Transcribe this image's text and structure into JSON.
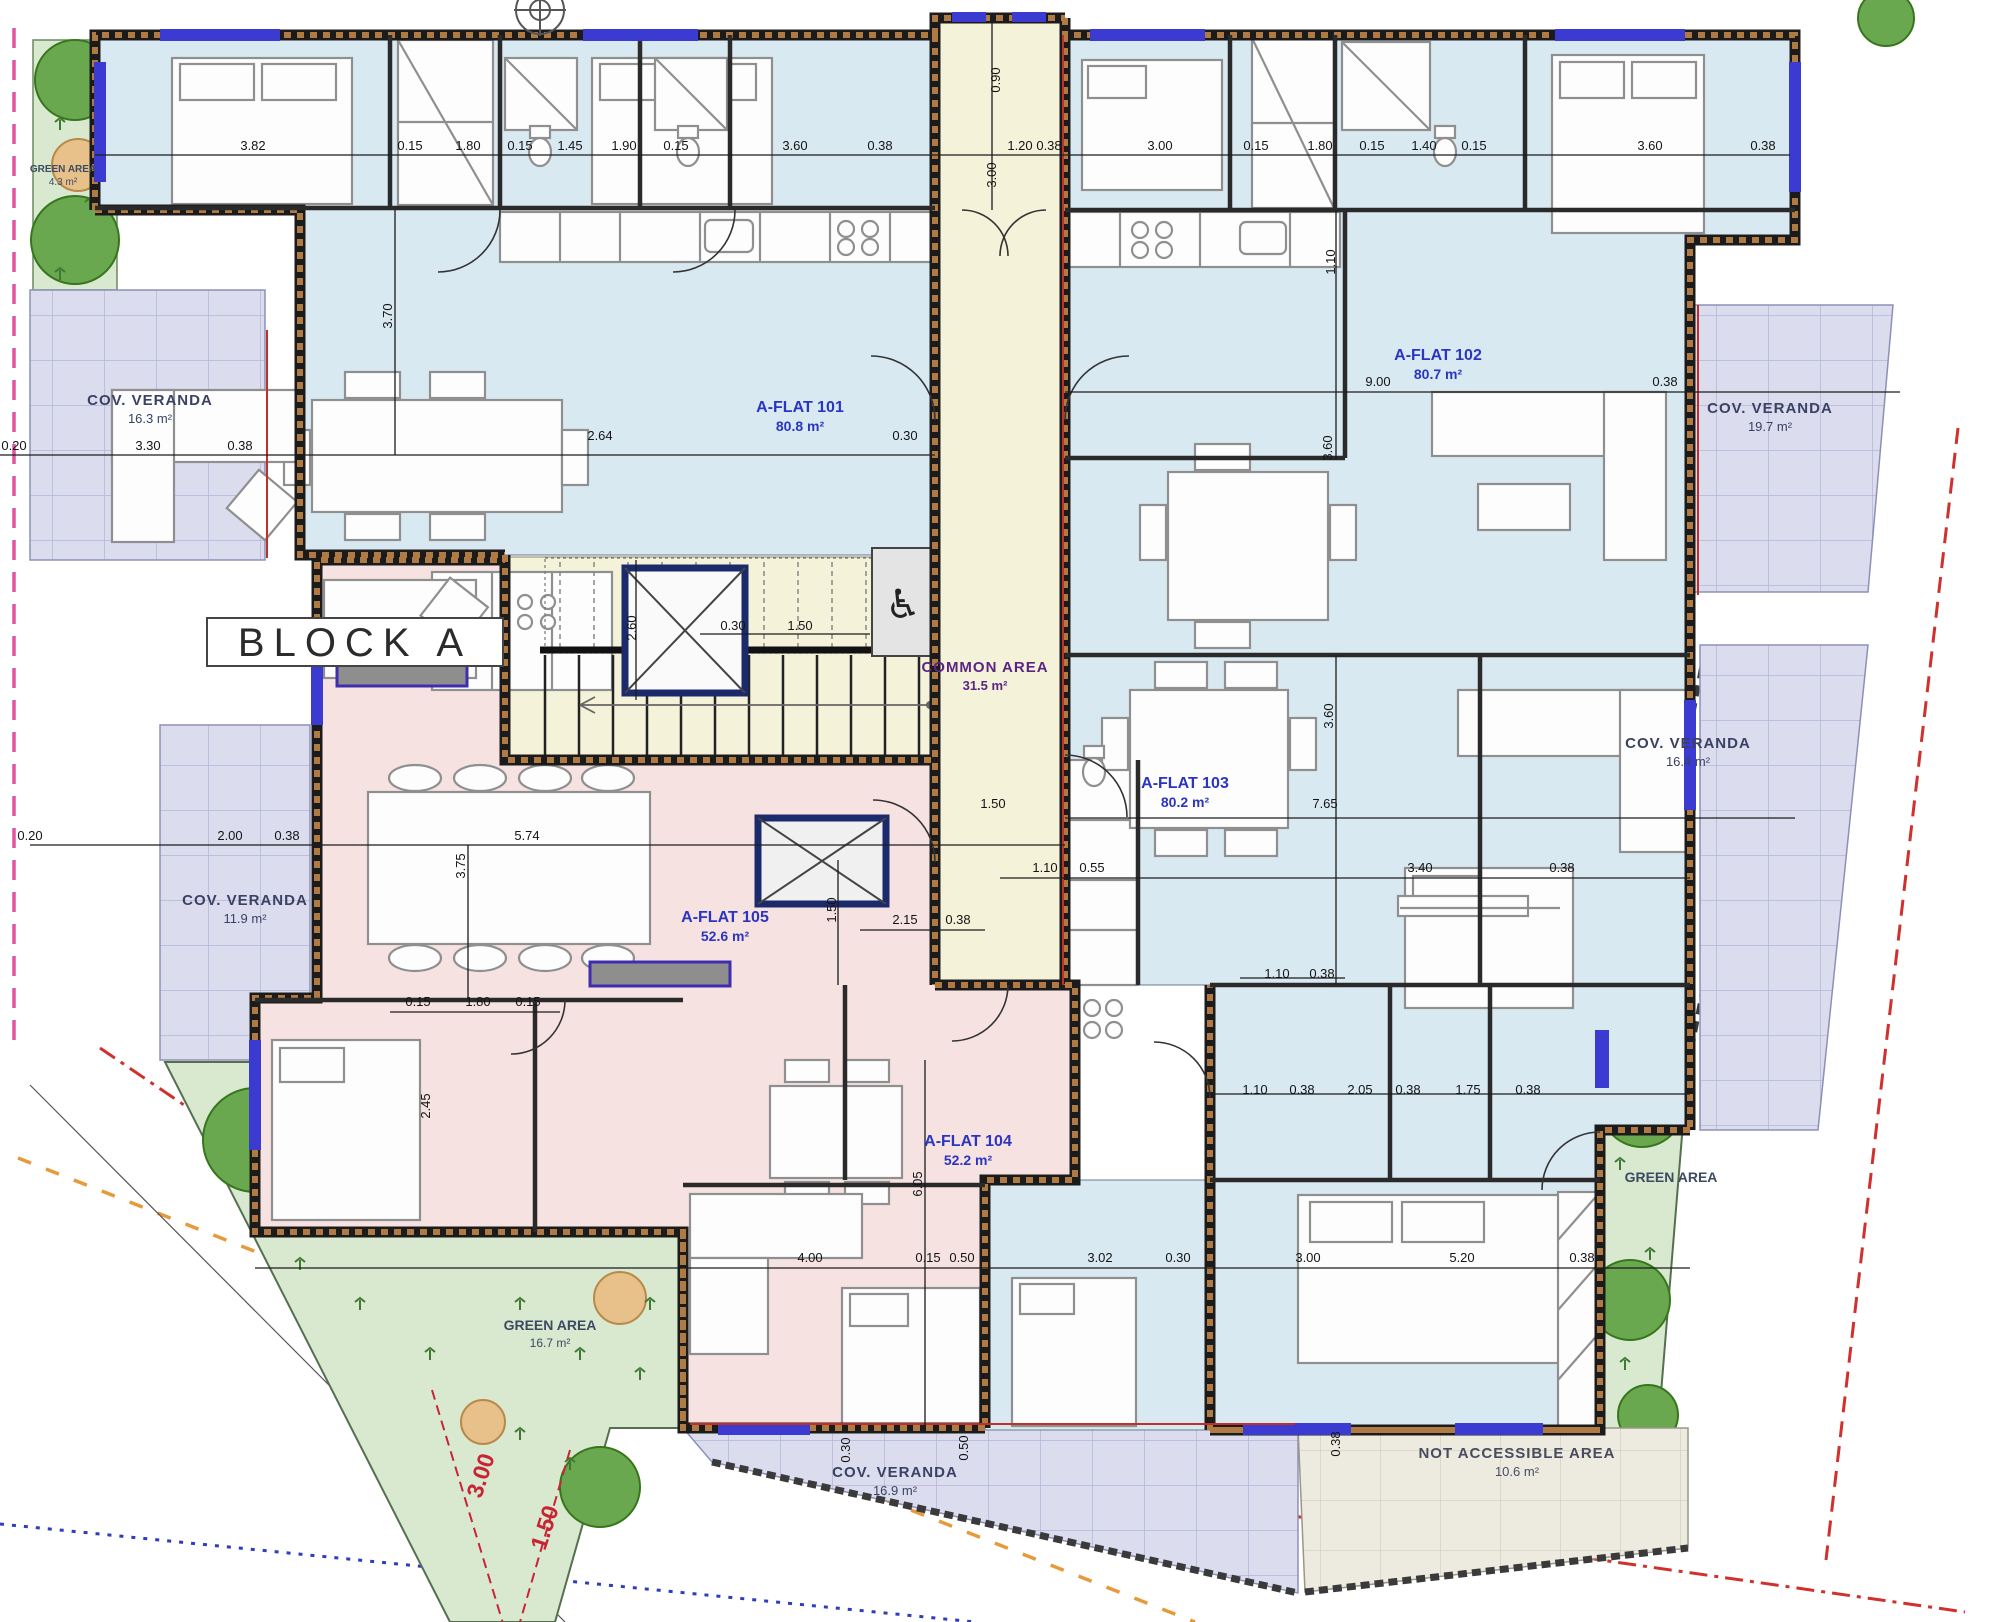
{
  "drawing": {
    "block_label": "BLOCK A",
    "flats": [
      {
        "name": "A-FLAT 101",
        "area": "80.8 m²",
        "x": 800,
        "y": 412
      },
      {
        "name": "A-FLAT 102",
        "area": "80.7 m²",
        "x": 1438,
        "y": 360
      },
      {
        "name": "A-FLAT 103",
        "area": "80.2 m²",
        "x": 1185,
        "y": 788
      },
      {
        "name": "A-FLAT 104",
        "area": "52.2 m²",
        "x": 968,
        "y": 1146
      },
      {
        "name": "A-FLAT 105",
        "area": "52.6 m²",
        "x": 725,
        "y": 922
      }
    ],
    "common": {
      "name": "COMMON AREA",
      "area": "31.5 m²",
      "x": 985,
      "y": 672
    },
    "verandas": [
      {
        "name": "COV. VERANDA",
        "area": "16.3 m²",
        "x": 150,
        "y": 405
      },
      {
        "name": "COV. VERANDA",
        "area": "19.7 m²",
        "x": 1770,
        "y": 413
      },
      {
        "name": "COV. VERANDA",
        "area": "16.4 m²",
        "x": 1688,
        "y": 748
      },
      {
        "name": "COV. VERANDA",
        "area": "11.9 m²",
        "x": 245,
        "y": 905
      },
      {
        "name": "COV. VERANDA",
        "area": "16.9 m²",
        "x": 895,
        "y": 1477
      }
    ],
    "not_accessible": {
      "name": "NOT ACCESSIBLE AREA",
      "area": "10.6 m²",
      "x": 1517,
      "y": 1458
    },
    "greens": [
      {
        "name": "GREEN AREA",
        "area": "4.3 m²",
        "x": 63,
        "y": 172,
        "small": true
      },
      {
        "name": "GREEN AREA",
        "area": "16.7 m²",
        "x": 550,
        "y": 1330
      },
      {
        "name": "GREEN AREA",
        "area": "",
        "x": 1671,
        "y": 1182
      }
    ],
    "dimensions": [
      {
        "t": "3.82",
        "x": 253,
        "y": 150
      },
      {
        "t": "0.15",
        "x": 410,
        "y": 150
      },
      {
        "t": "1.80",
        "x": 468,
        "y": 150
      },
      {
        "t": "0.15",
        "x": 520,
        "y": 150
      },
      {
        "t": "1.45",
        "x": 570,
        "y": 150
      },
      {
        "t": "1.90",
        "x": 624,
        "y": 150
      },
      {
        "t": "0.15",
        "x": 676,
        "y": 150
      },
      {
        "t": "3.60",
        "x": 795,
        "y": 150
      },
      {
        "t": "0.38",
        "x": 880,
        "y": 150
      },
      {
        "t": "1.20",
        "x": 1020,
        "y": 150
      },
      {
        "t": "0.38",
        "x": 1049,
        "y": 150
      },
      {
        "t": "3.00",
        "x": 1160,
        "y": 150
      },
      {
        "t": "0.15",
        "x": 1256,
        "y": 150
      },
      {
        "t": "1.80",
        "x": 1320,
        "y": 150
      },
      {
        "t": "0.15",
        "x": 1372,
        "y": 150
      },
      {
        "t": "1.40",
        "x": 1424,
        "y": 150
      },
      {
        "t": "0.15",
        "x": 1474,
        "y": 150
      },
      {
        "t": "3.60",
        "x": 1650,
        "y": 150
      },
      {
        "t": "0.38",
        "x": 1763,
        "y": 150
      },
      {
        "t": "0.20",
        "x": 14,
        "y": 450
      },
      {
        "t": "3.30",
        "x": 148,
        "y": 450
      },
      {
        "t": "0.38",
        "x": 240,
        "y": 450
      },
      {
        "t": "2.64",
        "x": 600,
        "y": 440
      },
      {
        "t": "0.30",
        "x": 905,
        "y": 440
      },
      {
        "t": "9.00",
        "x": 1378,
        "y": 386
      },
      {
        "t": "0.38",
        "x": 1665,
        "y": 386
      },
      {
        "t": "0.30",
        "x": 733,
        "y": 630
      },
      {
        "t": "1.50",
        "x": 800,
        "y": 630
      },
      {
        "t": "0.20",
        "x": 30,
        "y": 840
      },
      {
        "t": "2.00",
        "x": 230,
        "y": 840
      },
      {
        "t": "0.38",
        "x": 287,
        "y": 840
      },
      {
        "t": "5.74",
        "x": 527,
        "y": 840
      },
      {
        "t": "1.50",
        "x": 993,
        "y": 808
      },
      {
        "t": "7.65",
        "x": 1325,
        "y": 808
      },
      {
        "t": "1.10",
        "x": 1045,
        "y": 872
      },
      {
        "t": "0.55",
        "x": 1092,
        "y": 872
      },
      {
        "t": "3.40",
        "x": 1420,
        "y": 872
      },
      {
        "t": "0.38",
        "x": 1562,
        "y": 872
      },
      {
        "t": "0.15",
        "x": 418,
        "y": 1006
      },
      {
        "t": "1.80",
        "x": 478,
        "y": 1006
      },
      {
        "t": "0.15",
        "x": 528,
        "y": 1006
      },
      {
        "t": "2.15",
        "x": 905,
        "y": 924
      },
      {
        "t": "0.38",
        "x": 958,
        "y": 924
      },
      {
        "t": "1.10",
        "x": 1277,
        "y": 978
      },
      {
        "t": "0.38",
        "x": 1322,
        "y": 978
      },
      {
        "t": "1.10",
        "x": 1255,
        "y": 1094
      },
      {
        "t": "0.38",
        "x": 1302,
        "y": 1094
      },
      {
        "t": "2.05",
        "x": 1360,
        "y": 1094
      },
      {
        "t": "0.38",
        "x": 1408,
        "y": 1094
      },
      {
        "t": "1.75",
        "x": 1468,
        "y": 1094
      },
      {
        "t": "0.38",
        "x": 1528,
        "y": 1094
      },
      {
        "t": "4.00",
        "x": 810,
        "y": 1262
      },
      {
        "t": "0.15",
        "x": 928,
        "y": 1262
      },
      {
        "t": "0.50",
        "x": 962,
        "y": 1262
      },
      {
        "t": "3.02",
        "x": 1100,
        "y": 1262
      },
      {
        "t": "0.30",
        "x": 1178,
        "y": 1262
      },
      {
        "t": "3.00",
        "x": 1308,
        "y": 1262
      },
      {
        "t": "5.20",
        "x": 1462,
        "y": 1262
      },
      {
        "t": "0.38",
        "x": 1582,
        "y": 1262
      },
      {
        "t": "0.90",
        "x": 1000,
        "y": 80,
        "r": -90
      },
      {
        "t": "3.00",
        "x": 996,
        "y": 175,
        "r": -90
      },
      {
        "t": "2.60",
        "x": 636,
        "y": 628,
        "r": -90
      },
      {
        "t": "1.50",
        "x": 836,
        "y": 910,
        "r": -90
      },
      {
        "t": "3.60",
        "x": 1332,
        "y": 448,
        "r": -90
      },
      {
        "t": "3.60",
        "x": 1333,
        "y": 716,
        "r": -90
      },
      {
        "t": "6.05",
        "x": 922,
        "y": 1184,
        "r": -90
      },
      {
        "t": "3.75",
        "x": 465,
        "y": 866,
        "r": -90
      },
      {
        "t": "3.70",
        "x": 392,
        "y": 316,
        "r": -90
      },
      {
        "t": "1.10",
        "x": 1335,
        "y": 262,
        "r": -90
      },
      {
        "t": "2.45",
        "x": 430,
        "y": 1106,
        "r": -90
      },
      {
        "t": "0.30",
        "x": 850,
        "y": 1450,
        "r": -90
      },
      {
        "t": "0.50",
        "x": 968,
        "y": 1448,
        "r": -90
      },
      {
        "t": "0.38",
        "x": 1340,
        "y": 1444,
        "r": -90
      },
      {
        "t": "3.00",
        "x": 488,
        "y": 1478,
        "r": -72,
        "c": "red"
      },
      {
        "t": "1.50",
        "x": 552,
        "y": 1530,
        "r": -72,
        "c": "red"
      }
    ],
    "symbols": {
      "wheelchair": "♿"
    },
    "colors": {
      "room_blue": "#d9e9f1",
      "room_pink": "#f7e2e2",
      "common_cream": "#f5f2da",
      "veranda_lilac": "#dcdcef",
      "green": "#d8e9d0",
      "not_accessible": "#edebe0",
      "wall": "#1b1b1b",
      "wall_hatch": "#b07a45",
      "window_blue": "#3b3bd1",
      "boundary_pink": "#e0559f",
      "boundary_red": "#d0312d",
      "boundary_orange": "#e59a3c",
      "boundary_blue": "#2c3ebd",
      "label_blue": "#2a35c0",
      "label_purple": "#5a2483"
    }
  }
}
